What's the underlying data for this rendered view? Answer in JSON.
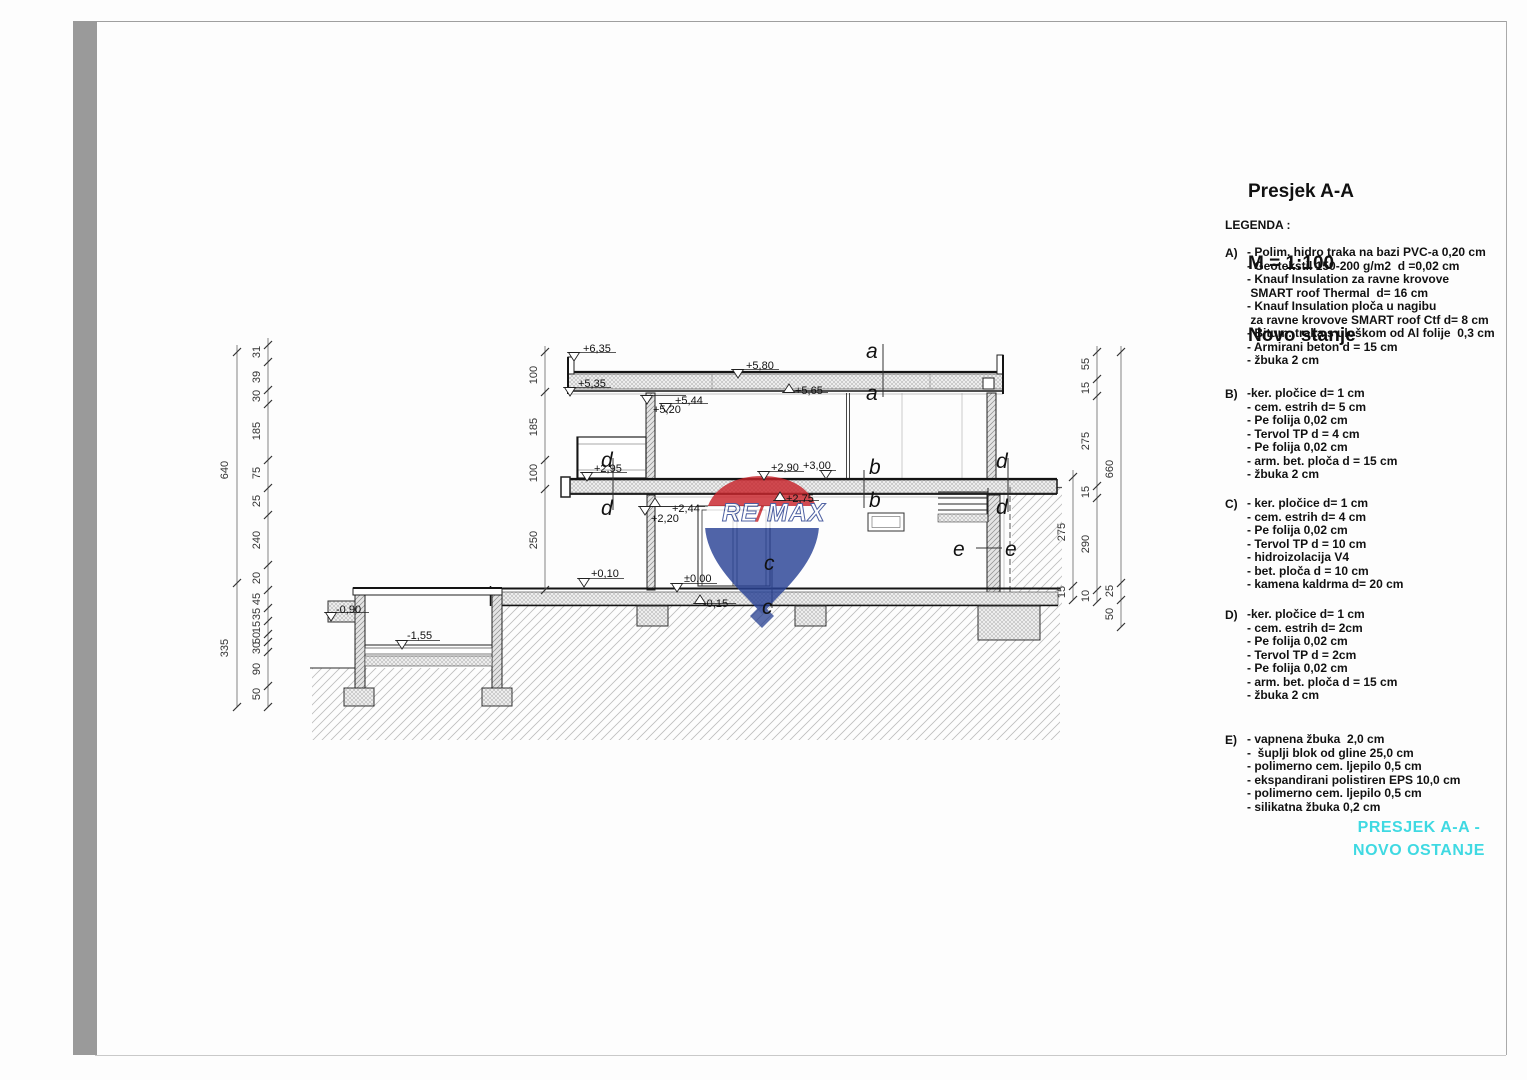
{
  "page": {
    "frame_bar_color": "#9a9a9a",
    "border_color": "#a0a0a0",
    "background": "#ffffff"
  },
  "title_block": {
    "line1": "Presjek A-A",
    "line2": "M = 1:100",
    "line3": "Novo stanje"
  },
  "legend": {
    "heading": "LEGENDA :",
    "sections": [
      {
        "key": "A)",
        "lines": [
          "- Polim. hidro traka na bazi PVC-a 0,20 cm",
          "- Geotekstil 150-200 g/m2  d =0,02 cm",
          "- Knauf Insulation za ravne krovove",
          " SMART roof Thermal  d= 16 cm",
          "- Knauf Insulation ploča u nagibu",
          " za ravne krovove SMART roof Ctf d= 8 cm",
          "- Bitum. traka s uloškom od Al folije  0,3 cm",
          "- Armirani beton d = 15 cm",
          "- žbuka 2 cm"
        ]
      },
      {
        "key": "B)",
        "lines": [
          "-ker. pločice d= 1 cm",
          "- cem. estrih d= 5 cm",
          "- Pe folija 0,02 cm",
          "- Tervol TP d = 4 cm",
          "- Pe folija 0,02 cm",
          "- arm. bet. ploča d = 15 cm",
          "- žbuka 2 cm"
        ]
      },
      {
        "key": "C)",
        "lines": [
          "- ker. pločice d= 1 cm",
          "- cem. estrih d= 4 cm",
          "- Pe folija 0,02 cm",
          "- Tervol TP d = 10 cm",
          "- hidroizolacija V4",
          "- bet. ploča d = 10 cm",
          "- kamena kaldrma d= 20 cm"
        ]
      },
      {
        "key": "D)",
        "lines": [
          "-ker. pločice d= 1 cm",
          "- cem. estrih d= 2cm",
          "- Pe folija 0,02 cm",
          "- Tervol TP d = 2cm",
          "- Pe folija 0,02 cm",
          "- arm. bet. ploča d = 15 cm",
          "- žbuka 2 cm"
        ]
      },
      {
        "key": "E)",
        "lines": [
          "- vapnena žbuka  2,0 cm",
          "-  šuplji blok od gline 25,0 cm",
          "- polimerno cem. ljepilo 0,5 cm",
          "- ekspandirani polistiren EPS 10,0 cm",
          "- polimerno cem. ljepilo 0,5 cm",
          "- silikatna žbuka 0,2 cm"
        ]
      }
    ]
  },
  "caption": {
    "line1": "PRESJEK A-A -",
    "line2": "NOVO OSTANJE",
    "color": "#3fd9e2"
  },
  "drawing": {
    "logo": {
      "re": "RE",
      "slash": "/",
      "max": "MAX",
      "red": "#c9252c",
      "blue": "#2a4396"
    },
    "elevations": [
      {
        "label": "+6,35",
        "x": 583,
        "y": 352,
        "m": "d",
        "mx": 574,
        "my": 361
      },
      {
        "label": "+5,80",
        "x": 746,
        "y": 369,
        "m": "d",
        "mx": 738,
        "my": 378
      },
      {
        "label": "+5,35",
        "x": 578,
        "y": 387,
        "m": "d",
        "mx": 570,
        "my": 396
      },
      {
        "label": "+5,65",
        "x": 795,
        "y": 394,
        "m": "u",
        "mx": 789,
        "my": 384
      },
      {
        "label": "+5,44",
        "x": 675,
        "y": 404,
        "m": "d",
        "mx": 666,
        "my": 412
      },
      {
        "label": "+5,20",
        "x": 653,
        "y": 413,
        "m": "d",
        "mx": 647,
        "my": 404
      },
      {
        "label": "+2,95",
        "x": 594,
        "y": 472,
        "m": "d",
        "mx": 587,
        "my": 481
      },
      {
        "label": "+2,90",
        "x": 771,
        "y": 471,
        "m": "d",
        "mx": 764,
        "my": 480
      },
      {
        "label": "+3,00",
        "x": 803,
        "y": 469,
        "m": "d",
        "mx": 826,
        "my": 479
      },
      {
        "label": "+2,75",
        "x": 786,
        "y": 502,
        "m": "u",
        "mx": 780,
        "my": 492
      },
      {
        "label": "+2,44",
        "x": 672,
        "y": 512,
        "m": "u",
        "mx": 655,
        "my": 498
      },
      {
        "label": "+2,20",
        "x": 651,
        "y": 522,
        "m": "d",
        "mx": 645,
        "my": 515
      },
      {
        "label": "+0,10",
        "x": 591,
        "y": 577,
        "m": "d",
        "mx": 584,
        "my": 587
      },
      {
        "label": "±0,00",
        "x": 684,
        "y": 582,
        "m": "d",
        "mx": 677,
        "my": 592
      },
      {
        "label": "-0,15",
        "x": 703,
        "y": 607,
        "m": "u",
        "mx": 700,
        "my": 595
      },
      {
        "label": "-0,90",
        "x": 336,
        "y": 613,
        "m": "d",
        "mx": 331,
        "my": 621
      },
      {
        "label": "-1,55",
        "x": 407,
        "y": 639,
        "m": "d",
        "mx": 402,
        "my": 649
      }
    ],
    "letters": [
      {
        "t": "a",
        "x": 866,
        "y": 358
      },
      {
        "t": "a",
        "x": 866,
        "y": 400
      },
      {
        "t": "b",
        "x": 869,
        "y": 474
      },
      {
        "t": "b",
        "x": 869,
        "y": 507
      },
      {
        "t": "c",
        "x": 764,
        "y": 570
      },
      {
        "t": "c",
        "x": 762,
        "y": 614
      },
      {
        "t": "d",
        "x": 601,
        "y": 467
      },
      {
        "t": "d",
        "x": 601,
        "y": 515
      },
      {
        "t": "d",
        "x": 996,
        "y": 468
      },
      {
        "t": "d",
        "x": 996,
        "y": 514
      },
      {
        "t": "e",
        "x": 953,
        "y": 556
      },
      {
        "t": "e",
        "x": 1005,
        "y": 556
      }
    ],
    "dim_chains": [
      {
        "x": 237,
        "tx": 228,
        "line": [
          345,
          707
        ],
        "ticks": [
          352,
          583,
          707
        ],
        "items": [
          {
            "l": "640",
            "y": 470
          },
          {
            "l": "335",
            "y": 648
          }
        ]
      },
      {
        "x": 268,
        "tx": 260,
        "line": [
          338,
          707
        ],
        "ticks": [
          345,
          362,
          390,
          404,
          460,
          488,
          515,
          565,
          590,
          608,
          621,
          634,
          642,
          652,
          686,
          707
        ],
        "items": [
          {
            "l": "31",
            "y": 352
          },
          {
            "l": "39",
            "y": 377
          },
          {
            "l": "30",
            "y": 396
          },
          {
            "l": "185",
            "y": 431
          },
          {
            "l": "75",
            "y": 473
          },
          {
            "l": "25",
            "y": 501
          },
          {
            "l": "240",
            "y": 540
          },
          {
            "l": "20",
            "y": 578
          },
          {
            "l": "45",
            "y": 599
          },
          {
            "l": "35",
            "y": 614
          },
          {
            "l": "15",
            "y": 627
          },
          {
            "l": "50",
            "y": 638
          },
          {
            "l": "30",
            "y": 648
          },
          {
            "l": "90",
            "y": 669
          },
          {
            "l": "50",
            "y": 694
          }
        ]
      },
      {
        "x": 545,
        "tx": 537,
        "line": [
          346,
          590
        ],
        "ticks": [
          352,
          392,
          460,
          489,
          590
        ],
        "items": [
          {
            "l": "100",
            "y": 375
          },
          {
            "l": "185",
            "y": 427
          },
          {
            "l": "100",
            "y": 473
          },
          {
            "l": "250",
            "y": 540
          }
        ]
      },
      {
        "x": 1073,
        "tx": 1065,
        "line": [
          470,
          600
        ],
        "ticks": [
          477,
          586,
          600
        ],
        "items": [
          {
            "l": "275",
            "y": 532
          },
          {
            "l": "15",
            "y": 592
          }
        ]
      },
      {
        "x": 1097,
        "tx": 1089,
        "line": [
          346,
          602
        ],
        "ticks": [
          352,
          379,
          396,
          486,
          498,
          590,
          602
        ],
        "items": [
          {
            "l": "55",
            "y": 364
          },
          {
            "l": "15",
            "y": 388
          },
          {
            "l": "275",
            "y": 441
          },
          {
            "l": "15",
            "y": 492
          },
          {
            "l": "290",
            "y": 544
          },
          {
            "l": "10",
            "y": 596
          }
        ]
      },
      {
        "x": 1121,
        "tx": 1113,
        "line": [
          346,
          627
        ],
        "ticks": [
          352,
          583,
          600,
          627
        ],
        "items": [
          {
            "l": "660",
            "y": 469
          },
          {
            "l": "25",
            "y": 591
          },
          {
            "l": "50",
            "y": 614
          }
        ]
      }
    ]
  }
}
